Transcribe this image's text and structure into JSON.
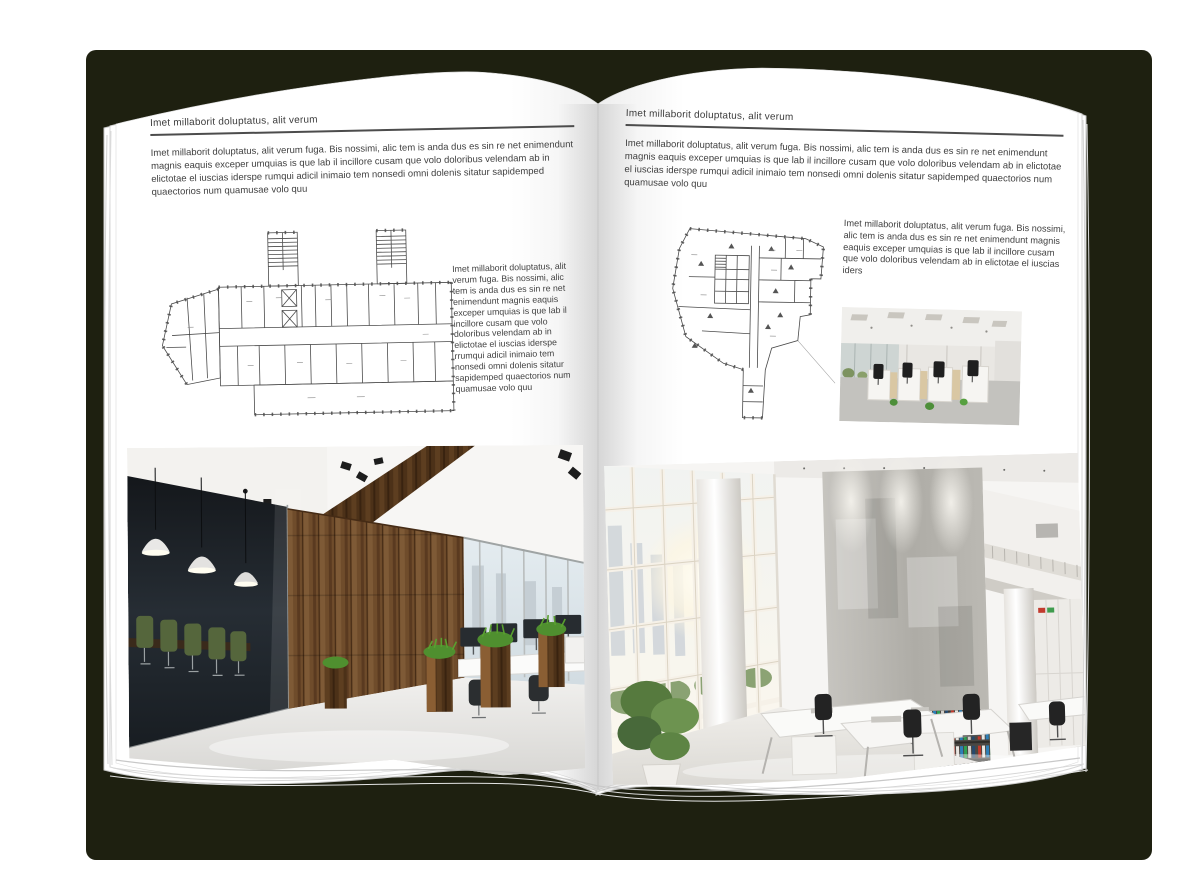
{
  "colors": {
    "backdrop": "#1e2010",
    "page": "#ffffff",
    "text": "#3f3f3f",
    "rule": "#4c4c4c",
    "plan_line": "#4a4a4a",
    "wood": "#6f4c2b",
    "grass": "#59a02f",
    "chair_green": "#55663c",
    "binder_red": "#c0392b",
    "binder_green": "#2f9e53",
    "binder_blue": "#2d7fb8"
  },
  "left_page": {
    "header": "Imet millaborit doluptatus, alit verum",
    "intro": "Imet millaborit doluptatus, alit verum fuga. Bis nossimi, alic tem is anda dus es sin re net enimendunt magnis eaquis exceper umquias is que lab il incillore cusam que volo doloribus velendam ab in elictotae el iuscias iderspe rumqui adicil inimaio tem nonsedi omni dolenis sitatur sapidemped quaectorios num quamusae volo quu",
    "side_text": "Imet millaborit doluptatus, alit verum fuga. Bis nossimi, alic tem is anda dus es sin re net enimendunt magnis eaquis exceper umquias is que lab il incillore cusam que volo doloribus velendam ab in elictotae el iuscias iderspe rrumqui adicil inimaio tem nonsedi omni dolenis sitatur sapidemped quaectorios num quamusae volo quu"
  },
  "right_page": {
    "header": "Imet millaborit doluptatus, alit verum",
    "intro": "Imet millaborit doluptatus, alit verum fuga. Bis nossimi, alic tem is anda dus es sin re net enimendunt magnis eaquis exceper umquias is que lab il incillore cusam que volo doloribus velendam ab in elictotae el iuscias iderspe rumqui adicil inimaio tem nonsedi omni dolenis sitatur sapidemped quaectorios num quamusae volo quu",
    "side_text": "Imet millaborit doluptatus, alit verum fuga. Bis nossimi, alic tem is anda dus es sin re net enimendunt magnis eaquis exceper umquias is que lab il incillore cusam que volo doloribus velendam ab in elictotae el iuscias iders"
  }
}
